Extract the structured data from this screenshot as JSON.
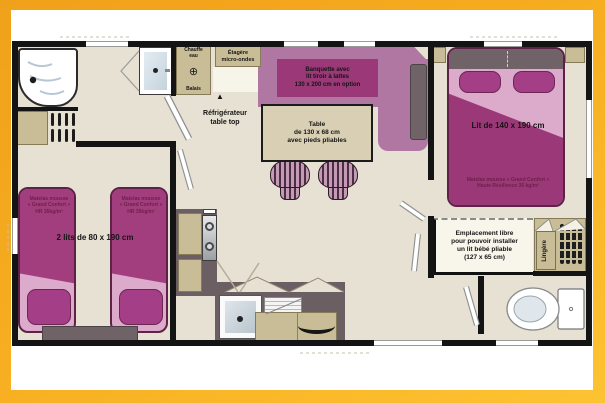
{
  "plan": {
    "labels": {
      "chauffe_eau": "Chauffe\neau",
      "balais": "Balais",
      "etagere": "Étagère\nmicro-ondes",
      "refrigerateur": "Réfrigérateur\ntable top",
      "banquette": "Banquette avec\nlit tiroir à lattes\n130 x 200 cm en option",
      "table": "Table\nde 130 x 68 cm\navec pieds pliables",
      "lit_double": "Lit de 140 x 190 cm",
      "matelas_double": "Matelas mousse « Grand Confort »\nHaute Résilience 35 kg/m³",
      "lits_jumeaux": "2 lits de 80 x 190 cm",
      "matelas_twin": "Matelas mousse\n« Grand Confort »\nHR 35kg/m³",
      "emplacement": "Emplacement libre\npour pouvoir installer\nun lit bébé pliable\n(127 x 65 cm)",
      "lingere": "Lingère"
    },
    "icons": {
      "heater_valve": "⊕",
      "fridge_arrow_up": "▲"
    },
    "colors": {
      "frame": "#F3A81C",
      "floor": "#E6E1D3",
      "wall": "#141414",
      "purple_dark": "#9A3878",
      "purple_mid": "#A23E7E",
      "purple_light": "#B077A3",
      "pink": "#DCAACB",
      "magenta_cushion": "#A33E87",
      "tan": "#C9BD97",
      "counter_gray": "#6C5F64",
      "label_maroon": "#6E1F4A"
    }
  }
}
